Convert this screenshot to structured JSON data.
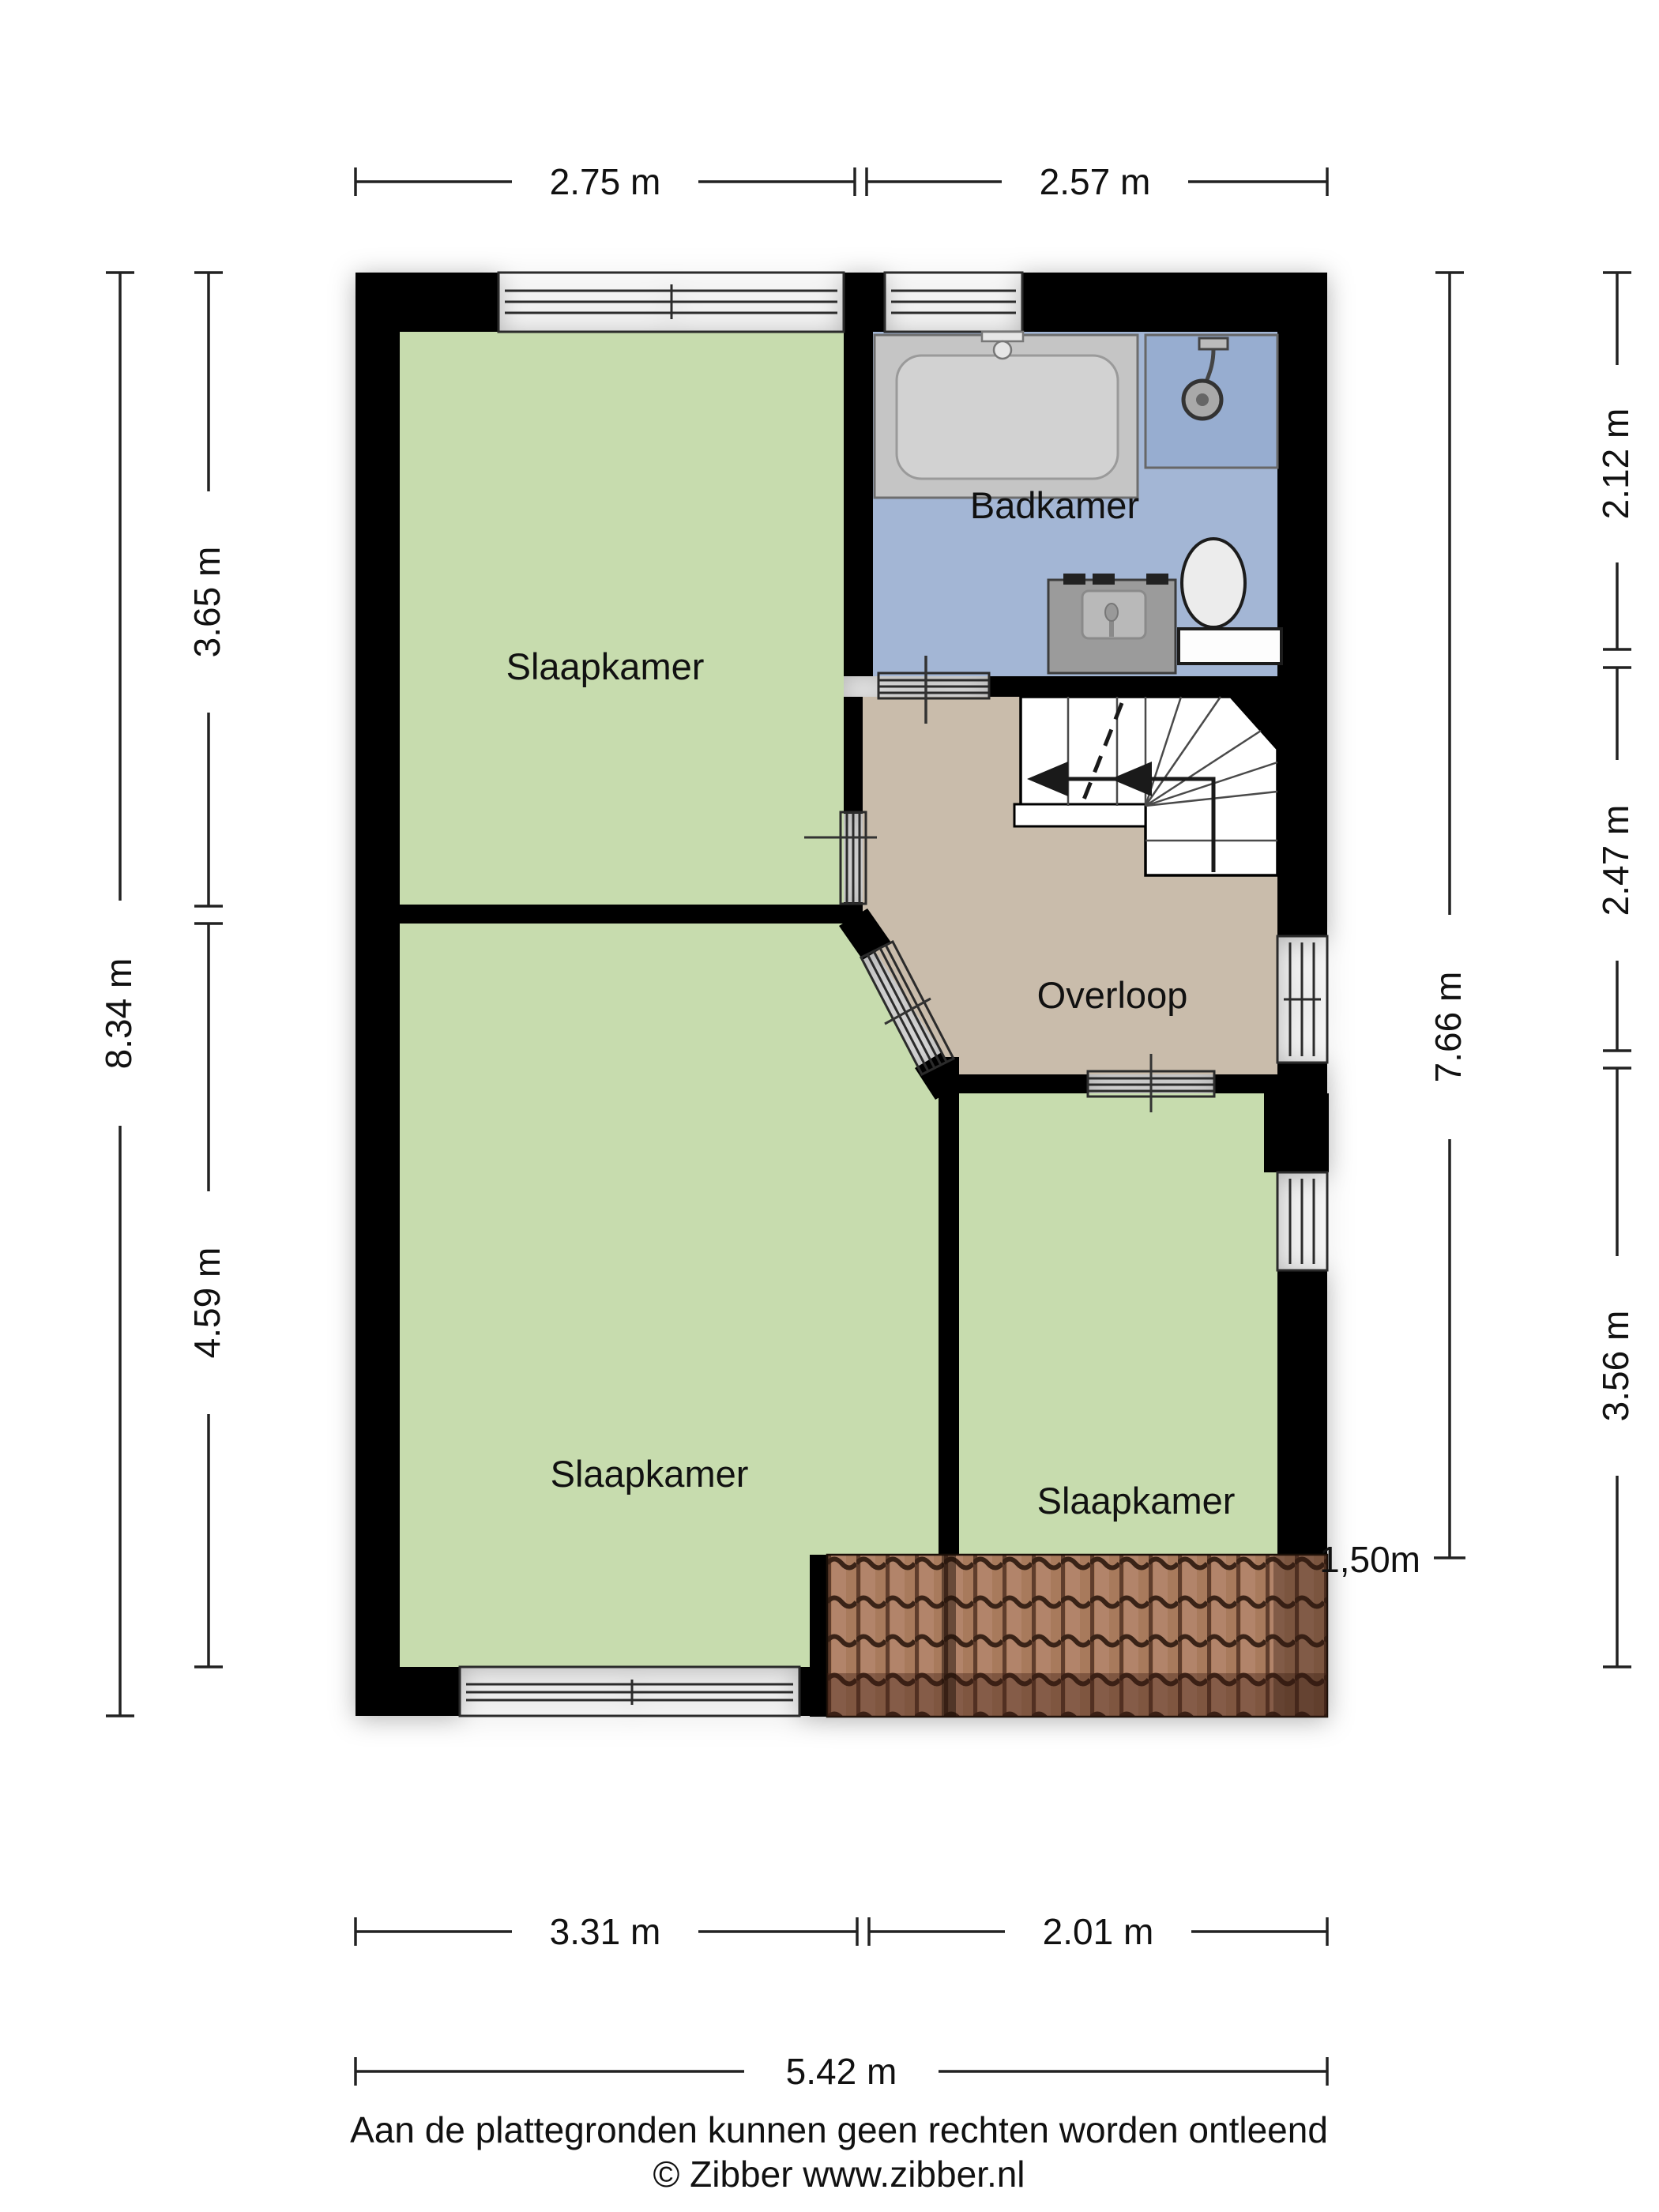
{
  "rooms": {
    "bedroom_top_left": "Slaapkamer",
    "bathroom": "Badkamer",
    "landing": "Overloop",
    "bedroom_bottom_left": "Slaapkamer",
    "bedroom_bottom_right": "Slaapkamer"
  },
  "dimensions": {
    "top_left": "2.75 m",
    "top_right": "2.57 m",
    "left_total": "8.34 m",
    "left_upper": "3.65 m",
    "left_lower": "4.59 m",
    "right_inner": "7.66 m",
    "right_upper": "2.12 m",
    "right_middle": "2.47 m",
    "right_lower": "3.56 m",
    "bottom_left": "3.31 m",
    "bottom_right": "2.01 m",
    "bottom_total": "5.42 m",
    "knee_wall_height": "1,50m"
  },
  "footer": {
    "line1": "Aan de plattegronden kunnen geen rechten worden ontleend",
    "line2": "© Zibber www.zibber.nl"
  },
  "colors": {
    "wall": "#000000",
    "bedroom": "#c7dcae",
    "bathroom": "#a3b6d5",
    "landing": "#c9bcab",
    "shower": "#97add0",
    "bathtub": "#c5c5c5",
    "bathtub_inner": "#d2d2d2",
    "vanity": "#9b9b9b",
    "stairs": "#ffffff",
    "roof_tile": "#a87a5c",
    "roof_tile_dark": "#6e4836"
  }
}
